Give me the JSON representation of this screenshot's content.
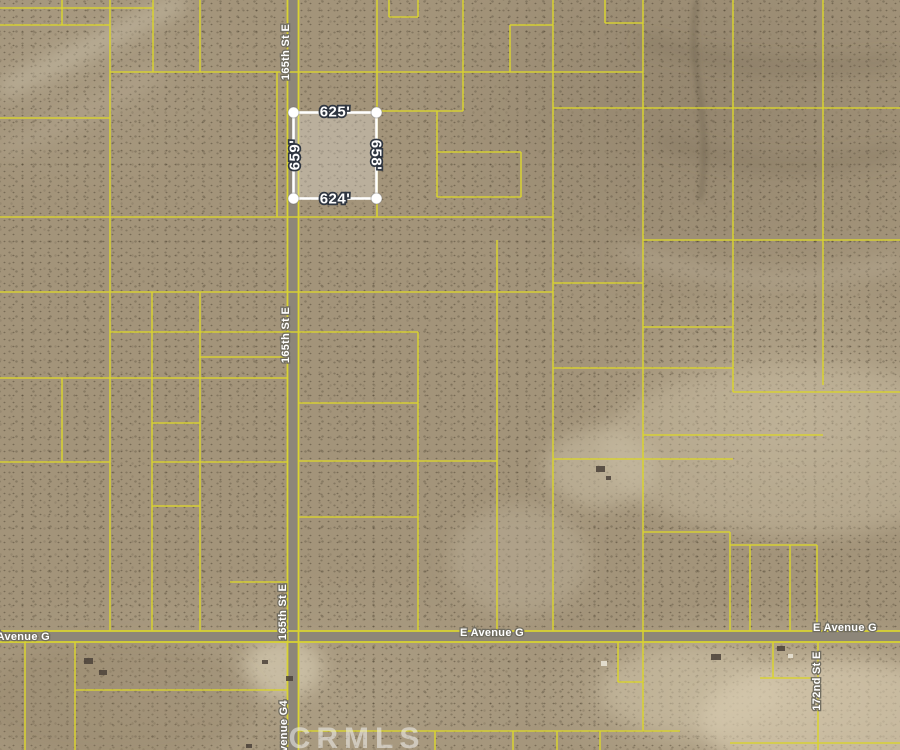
{
  "colors": {
    "lot-line": "#d9d331",
    "road-fill": "#8d8679",
    "parcel-stroke": "#ffffff",
    "parcel-fill": "rgba(255,255,255,0.26)",
    "label-outline": "#2e3540",
    "street-label-outline": "#716d60",
    "watermark-color": "rgba(240,240,238,0.55)"
  },
  "map": {
    "watermark": "CRMLS",
    "highlighted_parcel": {
      "top_dimension": "625'",
      "bottom_dimension": "624'",
      "left_dimension": "659'",
      "right_dimension": "658'"
    },
    "streets": {
      "vertical": "165th St E",
      "horizontal": "E Avenue G",
      "right_vertical": "172nd St E",
      "bottom_vertical": "Avenue G4"
    },
    "grid_segments": [
      [
        0,
        8,
        153,
        8
      ],
      [
        0,
        25,
        110,
        25
      ],
      [
        110,
        72,
        643,
        72
      ],
      [
        0,
        118,
        110,
        118
      ],
      [
        0,
        217,
        553,
        217
      ],
      [
        0,
        292,
        553,
        292
      ],
      [
        110,
        332,
        418,
        332
      ],
      [
        200,
        357,
        287,
        357
      ],
      [
        0,
        378,
        287,
        378
      ],
      [
        152,
        423,
        200,
        423
      ],
      [
        0,
        462,
        110,
        462
      ],
      [
        152,
        462,
        287,
        462
      ],
      [
        152,
        506,
        200,
        506
      ],
      [
        230,
        582,
        287,
        582
      ],
      [
        75,
        690,
        287,
        690
      ],
      [
        377,
        111,
        463,
        111
      ],
      [
        437,
        152,
        521,
        152
      ],
      [
        437,
        197,
        521,
        197
      ],
      [
        389,
        17,
        418,
        17
      ],
      [
        510,
        25,
        553,
        25
      ],
      [
        605,
        23,
        643,
        23
      ],
      [
        553,
        108,
        900,
        108
      ],
      [
        643,
        240,
        900,
        240
      ],
      [
        553,
        283,
        643,
        283
      ],
      [
        643,
        327,
        733,
        327
      ],
      [
        553,
        368,
        733,
        368
      ],
      [
        733,
        392,
        900,
        392
      ],
      [
        643,
        435,
        823,
        435
      ],
      [
        553,
        459,
        733,
        459
      ],
      [
        298,
        403,
        418,
        403
      ],
      [
        298,
        461,
        497,
        461
      ],
      [
        298,
        517,
        418,
        517
      ],
      [
        643,
        532,
        730,
        532
      ],
      [
        730,
        545,
        817,
        545
      ],
      [
        618,
        682,
        643,
        682
      ],
      [
        760,
        678,
        818,
        678
      ],
      [
        298,
        731,
        680,
        731
      ],
      [
        730,
        743,
        900,
        743
      ],
      [
        62,
        0,
        62,
        25
      ],
      [
        110,
        0,
        110,
        631
      ],
      [
        153,
        0,
        153,
        72
      ],
      [
        200,
        0,
        200,
        72
      ],
      [
        277,
        72,
        277,
        217
      ],
      [
        152,
        292,
        152,
        631
      ],
      [
        200,
        292,
        200,
        631
      ],
      [
        62,
        378,
        62,
        462
      ],
      [
        25,
        642,
        25,
        750
      ],
      [
        75,
        642,
        75,
        750
      ],
      [
        377,
        0,
        377,
        217
      ],
      [
        389,
        0,
        389,
        17
      ],
      [
        418,
        0,
        418,
        17
      ],
      [
        463,
        0,
        463,
        111
      ],
      [
        437,
        111,
        437,
        197
      ],
      [
        521,
        152,
        521,
        197
      ],
      [
        510,
        25,
        510,
        72
      ],
      [
        605,
        0,
        605,
        23
      ],
      [
        553,
        0,
        553,
        631
      ],
      [
        643,
        0,
        643,
        731
      ],
      [
        733,
        0,
        733,
        392
      ],
      [
        823,
        0,
        823,
        385
      ],
      [
        497,
        240,
        497,
        631
      ],
      [
        418,
        332,
        418,
        631
      ],
      [
        730,
        532,
        730,
        631
      ],
      [
        750,
        545,
        750,
        631
      ],
      [
        790,
        545,
        790,
        631
      ],
      [
        817,
        545,
        817,
        631
      ],
      [
        618,
        642,
        618,
        682
      ],
      [
        818,
        642,
        818,
        750
      ],
      [
        773,
        642,
        773,
        678
      ],
      [
        435,
        731,
        435,
        750
      ],
      [
        513,
        731,
        513,
        750
      ],
      [
        557,
        731,
        557,
        750
      ],
      [
        600,
        731,
        600,
        750
      ]
    ]
  }
}
